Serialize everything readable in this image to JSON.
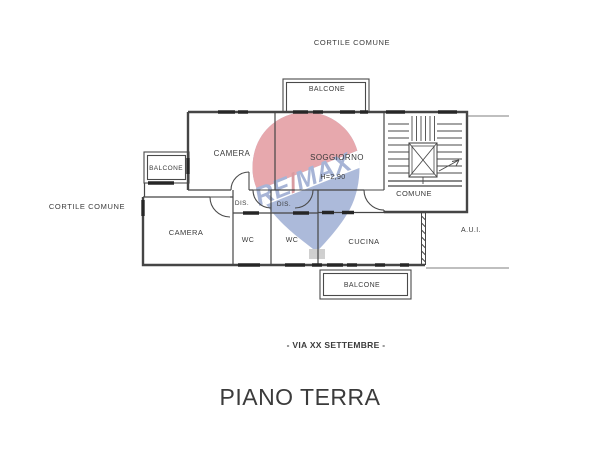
{
  "page": {
    "title": "PIANO TERRA",
    "street": "- VIA XX SETTEMBRE -"
  },
  "areas": {
    "cortile_top": "CORTILE COMUNE",
    "cortile_left": "CORTILE COMUNE",
    "aui": "A.U.I."
  },
  "rooms": {
    "balcone_top": "BALCONE",
    "balcone_left": "BALCONE",
    "balcone_bottom": "BALCONE",
    "camera_top": "CAMERA",
    "camera_bottom": "CAMERA",
    "soggiorno": "SOGGIORNO",
    "soggiorno_height": "H=2,90",
    "dis_1": "DIS.",
    "dis_2": "DIS.",
    "wc_1": "WC",
    "wc_2": "WC",
    "cucina": "CUCINA",
    "comune": "COMUNE"
  },
  "watermark": {
    "brand": "RE/MAX",
    "re": "RE",
    "slash": "/",
    "max": "MAX"
  },
  "colors": {
    "wall": "#454545",
    "window": "#262626",
    "text": "#3b3b3b",
    "remax_red": "#c8313e",
    "remax_blue": "#3c5ca8",
    "remax_text_blue": "#2f4f9e",
    "remax_slash_red": "#a51222"
  }
}
